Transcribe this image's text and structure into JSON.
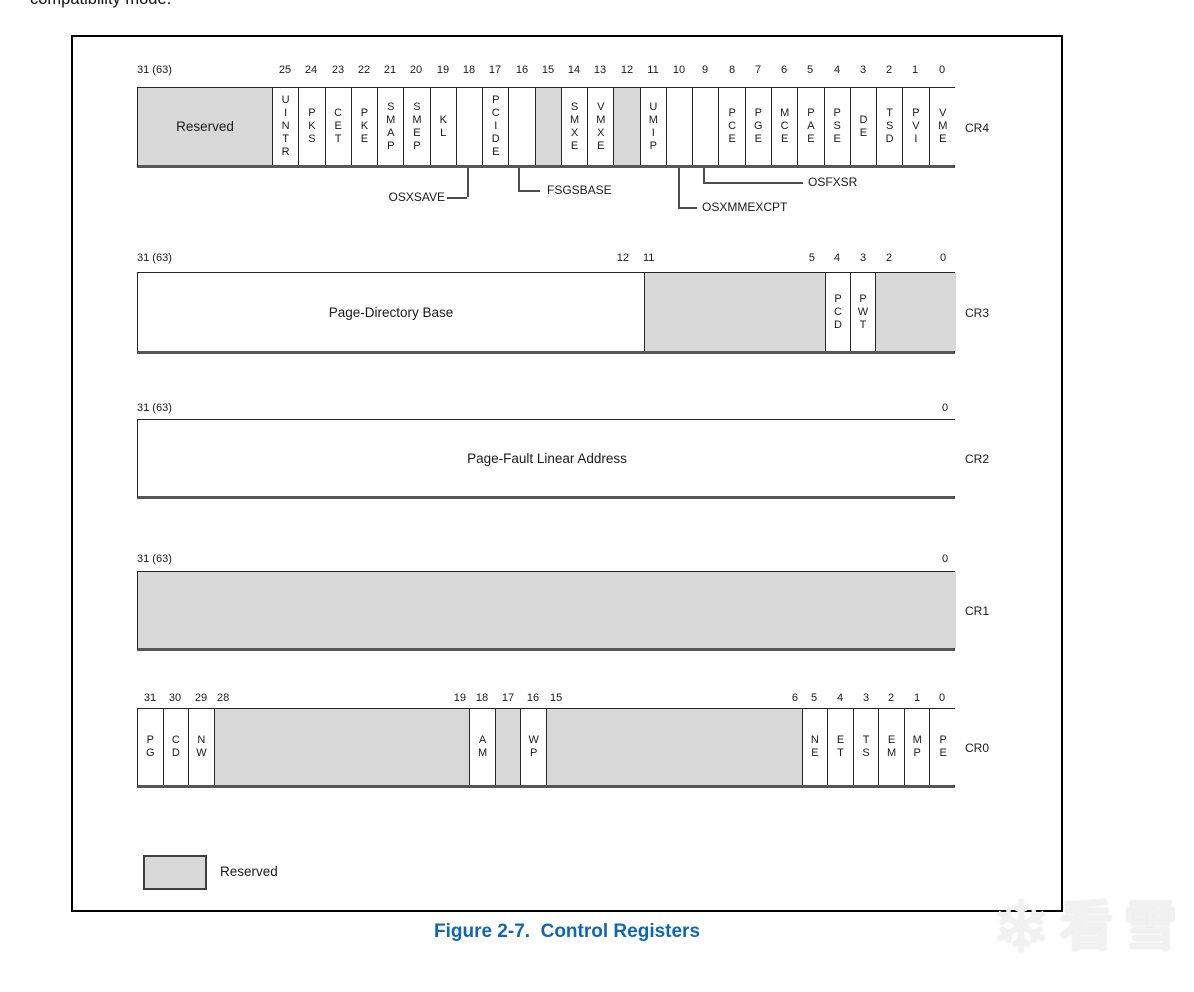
{
  "page": {
    "top_text": "compatibility mode.",
    "caption": "Figure 2-7.  Control Registers",
    "legend_label": "Reserved",
    "watermark_text": "看雪",
    "colors": {
      "reserved_fill": "#d8d8d8",
      "caption_blue": "#0f68af",
      "line_dark": "#262626"
    }
  },
  "registers": [
    {
      "name": "CR4",
      "ticks_y": 64,
      "box_top": 87,
      "box_h": 81,
      "ticks": [
        {
          "text": "31 (63)",
          "x": 0,
          "anchor": "left"
        },
        {
          "text": "25",
          "x": 148
        },
        {
          "text": "24",
          "x": 174
        },
        {
          "text": "23",
          "x": 201
        },
        {
          "text": "22",
          "x": 227
        },
        {
          "text": "21",
          "x": 253
        },
        {
          "text": "20",
          "x": 279
        },
        {
          "text": "19",
          "x": 306
        },
        {
          "text": "18",
          "x": 332
        },
        {
          "text": "17",
          "x": 358
        },
        {
          "text": "16",
          "x": 385
        },
        {
          "text": "15",
          "x": 411
        },
        {
          "text": "14",
          "x": 437
        },
        {
          "text": "13",
          "x": 463
        },
        {
          "text": "12",
          "x": 490
        },
        {
          "text": "11",
          "x": 516
        },
        {
          "text": "10",
          "x": 542
        },
        {
          "text": "9",
          "x": 568
        },
        {
          "text": "8",
          "x": 595
        },
        {
          "text": "7",
          "x": 621
        },
        {
          "text": "6",
          "x": 647
        },
        {
          "text": "5",
          "x": 673
        },
        {
          "text": "4",
          "x": 700
        },
        {
          "text": "3",
          "x": 726
        },
        {
          "text": "2",
          "x": 752
        },
        {
          "text": "1",
          "x": 778
        },
        {
          "text": "0",
          "x": 805
        }
      ],
      "cells": [
        {
          "bits": "31-26",
          "x": 0,
          "w": 135,
          "label": "Reserved",
          "dir": "h",
          "fill": "gray"
        },
        {
          "bits": "25",
          "x": 135,
          "w": 26.3,
          "label": "UINTR",
          "dir": "v"
        },
        {
          "bits": "24",
          "x": 161.3,
          "w": 26.3,
          "label": "PKS",
          "dir": "v"
        },
        {
          "bits": "23",
          "x": 187.5,
          "w": 26.3,
          "label": "CET",
          "dir": "v"
        },
        {
          "bits": "22",
          "x": 213.8,
          "w": 26.3,
          "label": "PKE",
          "dir": "v"
        },
        {
          "bits": "21",
          "x": 240.1,
          "w": 26.3,
          "label": "SMAP",
          "dir": "v"
        },
        {
          "bits": "20",
          "x": 266.3,
          "w": 26.3,
          "label": "SMEP",
          "dir": "v"
        },
        {
          "bits": "19",
          "x": 292.6,
          "w": 26.3,
          "label": "KL",
          "dir": "v"
        },
        {
          "bits": "18",
          "x": 318.8,
          "w": 26.3,
          "label": "",
          "dir": "v"
        },
        {
          "bits": "17",
          "x": 345.1,
          "w": 26.3,
          "label": "PCIDE",
          "dir": "v"
        },
        {
          "bits": "16",
          "x": 371.4,
          "w": 26.3,
          "label": "",
          "dir": "v"
        },
        {
          "bits": "15",
          "x": 397.6,
          "w": 26.3,
          "label": "",
          "dir": "v",
          "fill": "gray"
        },
        {
          "bits": "14",
          "x": 423.9,
          "w": 26.3,
          "label": "SMXE",
          "dir": "v"
        },
        {
          "bits": "13",
          "x": 450.2,
          "w": 26.3,
          "label": "VMXE",
          "dir": "v"
        },
        {
          "bits": "12",
          "x": 476.4,
          "w": 26.3,
          "label": "",
          "dir": "v",
          "fill": "gray"
        },
        {
          "bits": "11",
          "x": 502.7,
          "w": 26.3,
          "label": "UMIP",
          "dir": "v"
        },
        {
          "bits": "10",
          "x": 529.0,
          "w": 26.3,
          "label": "",
          "dir": "v"
        },
        {
          "bits": "9",
          "x": 555.2,
          "w": 26.3,
          "label": "",
          "dir": "v"
        },
        {
          "bits": "8",
          "x": 581.5,
          "w": 26.3,
          "label": "PCE",
          "dir": "v"
        },
        {
          "bits": "7",
          "x": 607.7,
          "w": 26.3,
          "label": "PGE",
          "dir": "v"
        },
        {
          "bits": "6",
          "x": 634.0,
          "w": 26.3,
          "label": "MCE",
          "dir": "v"
        },
        {
          "bits": "5",
          "x": 660.3,
          "w": 26.3,
          "label": "PAE",
          "dir": "v"
        },
        {
          "bits": "4",
          "x": 686.5,
          "w": 26.3,
          "label": "PSE",
          "dir": "v"
        },
        {
          "bits": "3",
          "x": 712.8,
          "w": 26.3,
          "label": "DE",
          "dir": "v"
        },
        {
          "bits": "2",
          "x": 739.0,
          "w": 26.3,
          "label": "TSD",
          "dir": "v"
        },
        {
          "bits": "1",
          "x": 765.3,
          "w": 26.3,
          "label": "PVI",
          "dir": "v"
        },
        {
          "bits": "0",
          "x": 791.6,
          "w": 26.4,
          "label": "VME",
          "dir": "v"
        }
      ],
      "callouts": [
        {
          "label": "OSXSAVE",
          "bit": "18",
          "line_x": 330,
          "drop": 29,
          "h_x1": 310,
          "h_x2": 330,
          "label_x": 308,
          "anchor": "right"
        },
        {
          "label": "FSGSBASE",
          "bit": "16",
          "line_x": 381,
          "drop": 22,
          "h_x1": 381,
          "h_x2": 403,
          "label_x": 410,
          "anchor": "left"
        },
        {
          "label": "OSXMMEXCPT",
          "bit": "10",
          "line_x": 541,
          "drop": 39,
          "h_x1": 541,
          "h_x2": 560,
          "label_x": 565,
          "anchor": "left"
        },
        {
          "label": "OSFXSR",
          "bit": "9",
          "line_x": 566,
          "drop": 14,
          "h_x1": 566,
          "h_x2": 666,
          "label_x": 671,
          "anchor": "left"
        }
      ]
    },
    {
      "name": "CR3",
      "ticks_y": 252,
      "box_top": 272,
      "box_h": 82,
      "ticks": [
        {
          "text": "31 (63)",
          "x": 0,
          "anchor": "left"
        },
        {
          "text": "12",
          "x": 492,
          "anchor": "right"
        },
        {
          "text": "11",
          "x": 506,
          "anchor": "left"
        },
        {
          "text": "5",
          "x": 678,
          "anchor": "right"
        },
        {
          "text": "4",
          "x": 700
        },
        {
          "text": "3",
          "x": 726
        },
        {
          "text": "2",
          "x": 752
        },
        {
          "text": "0",
          "x": 806
        }
      ],
      "cells": [
        {
          "bits": "31-12",
          "x": 0,
          "w": 507,
          "label": "Page-Directory Base",
          "dir": "h"
        },
        {
          "bits": "11-5",
          "x": 507,
          "w": 181,
          "label": "",
          "dir": "h",
          "fill": "gray"
        },
        {
          "bits": "4",
          "x": 688,
          "w": 25,
          "label": "PCD",
          "dir": "v"
        },
        {
          "bits": "3",
          "x": 713,
          "w": 25,
          "label": "PWT",
          "dir": "v"
        },
        {
          "bits": "2-0",
          "x": 738,
          "w": 80,
          "label": "",
          "dir": "h",
          "fill": "gray"
        }
      ],
      "callouts": []
    },
    {
      "name": "CR2",
      "ticks_y": 402,
      "box_top": 419,
      "box_h": 80,
      "ticks": [
        {
          "text": "31 (63)",
          "x": 0,
          "anchor": "left"
        },
        {
          "text": "0",
          "x": 808
        }
      ],
      "cells": [
        {
          "bits": "31-0",
          "x": 0,
          "w": 818,
          "label": "Page-Fault Linear Address",
          "dir": "h"
        }
      ],
      "callouts": []
    },
    {
      "name": "CR1",
      "ticks_y": 553,
      "box_top": 571,
      "box_h": 80,
      "ticks": [
        {
          "text": "31 (63)",
          "x": 0,
          "anchor": "left"
        },
        {
          "text": "0",
          "x": 808
        }
      ],
      "cells": [
        {
          "bits": "31-0",
          "x": 0,
          "w": 818,
          "label": "",
          "dir": "h",
          "fill": "gray"
        }
      ],
      "callouts": []
    },
    {
      "name": "CR0",
      "ticks_y": 692,
      "box_top": 708,
      "box_h": 80,
      "ticks": [
        {
          "text": "31",
          "x": 13
        },
        {
          "text": "30",
          "x": 38
        },
        {
          "text": "29",
          "x": 64
        },
        {
          "text": "28",
          "x": 80,
          "anchor": "left"
        },
        {
          "text": "19",
          "x": 329,
          "anchor": "right"
        },
        {
          "text": "18",
          "x": 345
        },
        {
          "text": "17",
          "x": 371
        },
        {
          "text": "16",
          "x": 396
        },
        {
          "text": "15",
          "x": 413,
          "anchor": "left"
        },
        {
          "text": "6",
          "x": 661,
          "anchor": "right"
        },
        {
          "text": "5",
          "x": 677
        },
        {
          "text": "4",
          "x": 703
        },
        {
          "text": "3",
          "x": 729
        },
        {
          "text": "2",
          "x": 754
        },
        {
          "text": "1",
          "x": 780
        },
        {
          "text": "0",
          "x": 805
        }
      ],
      "cells": [
        {
          "bits": "31",
          "x": 0,
          "w": 25.6,
          "label": "PG",
          "dir": "v"
        },
        {
          "bits": "30",
          "x": 25.6,
          "w": 25.6,
          "label": "CD",
          "dir": "v"
        },
        {
          "bits": "29",
          "x": 51.1,
          "w": 25.6,
          "label": "NW",
          "dir": "v"
        },
        {
          "bits": "28-19",
          "x": 76.7,
          "w": 255.6,
          "label": "",
          "dir": "h",
          "fill": "gray"
        },
        {
          "bits": "18",
          "x": 332.3,
          "w": 25.6,
          "label": "AM",
          "dir": "v"
        },
        {
          "bits": "17",
          "x": 357.9,
          "w": 25.6,
          "label": "",
          "dir": "v",
          "fill": "gray"
        },
        {
          "bits": "16",
          "x": 383.4,
          "w": 25.6,
          "label": "WP",
          "dir": "v"
        },
        {
          "bits": "15-6",
          "x": 409.0,
          "w": 255.6,
          "label": "",
          "dir": "h",
          "fill": "gray"
        },
        {
          "bits": "5",
          "x": 664.6,
          "w": 25.6,
          "label": "NE",
          "dir": "v"
        },
        {
          "bits": "4",
          "x": 690.2,
          "w": 25.6,
          "label": "ET",
          "dir": "v"
        },
        {
          "bits": "3",
          "x": 715.8,
          "w": 25.6,
          "label": "TS",
          "dir": "v"
        },
        {
          "bits": "2",
          "x": 741.3,
          "w": 25.6,
          "label": "EM",
          "dir": "v"
        },
        {
          "bits": "1",
          "x": 766.9,
          "w": 25.6,
          "label": "MP",
          "dir": "v"
        },
        {
          "bits": "0",
          "x": 792.4,
          "w": 25.6,
          "label": "PE",
          "dir": "v"
        }
      ],
      "callouts": []
    }
  ]
}
